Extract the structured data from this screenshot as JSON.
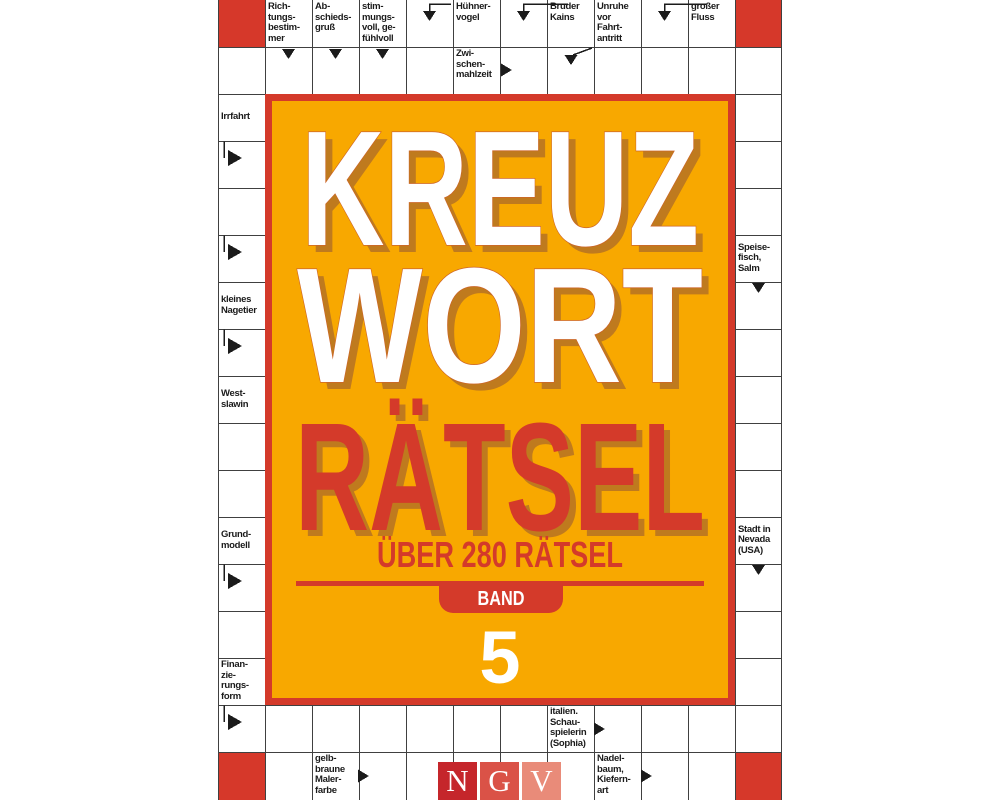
{
  "title": {
    "line1": "KREUZ",
    "line2": "WORT",
    "line3": "RÄTSEL",
    "subtitle": "ÜBER 280 RÄTSEL",
    "band_label": "BAND",
    "band_number": "5"
  },
  "publisher": {
    "name": "NGV",
    "letters": [
      "N",
      "G",
      "V"
    ]
  },
  "colors": {
    "panel_orange": "#f8a800",
    "panel_border_red": "#d43a2a",
    "title_red": "#d43a2a",
    "title_shadow_brown": "#bf7a1e",
    "title_outline": "#cd6428",
    "blocked_cell_red": "#d6382a",
    "grid_line": "#404040",
    "clue_text": "#1b1b1b",
    "ngv_n_red": "#c5262b",
    "ngv_g_red": "#da5247",
    "ngv_v_salmon": "#e98b79"
  },
  "crossword": {
    "clues": [
      {
        "text": "Rich-\ntungs-\nbestim-\nmer"
      },
      {
        "text": "Ab-\nschieds-\ngruß"
      },
      {
        "text": "stim-\nmungs-\nvoll, ge-\nfühlvoll"
      },
      {
        "text": "Hühner-\nvogel"
      },
      {
        "text": "Bruder\nKains"
      },
      {
        "text": "Unruhe\nvor\nFahrt-\nantritt"
      },
      {
        "text": "großer\nFluss"
      },
      {
        "text": "Zwi-\nschen-\nmahlzeit"
      },
      {
        "text": "Irrfahrt"
      },
      {
        "text": "kleines\nNagetier"
      },
      {
        "text": "West-\nslawin"
      },
      {
        "text": "Grund-\nmodell"
      },
      {
        "text": "Finan-\nzie-\nrungs-\nform"
      },
      {
        "text": "Speise-\nfisch,\nSalm"
      },
      {
        "text": "Stadt in\nNevada\n(USA)"
      },
      {
        "text": "italien.\nSchau-\nspielerin\n(Sophia)"
      },
      {
        "text": "gelb-\nbraune\nMaler-\nfarbe"
      },
      {
        "text": "Nadel-\nbaum,\nKiefern-\nart"
      }
    ]
  }
}
